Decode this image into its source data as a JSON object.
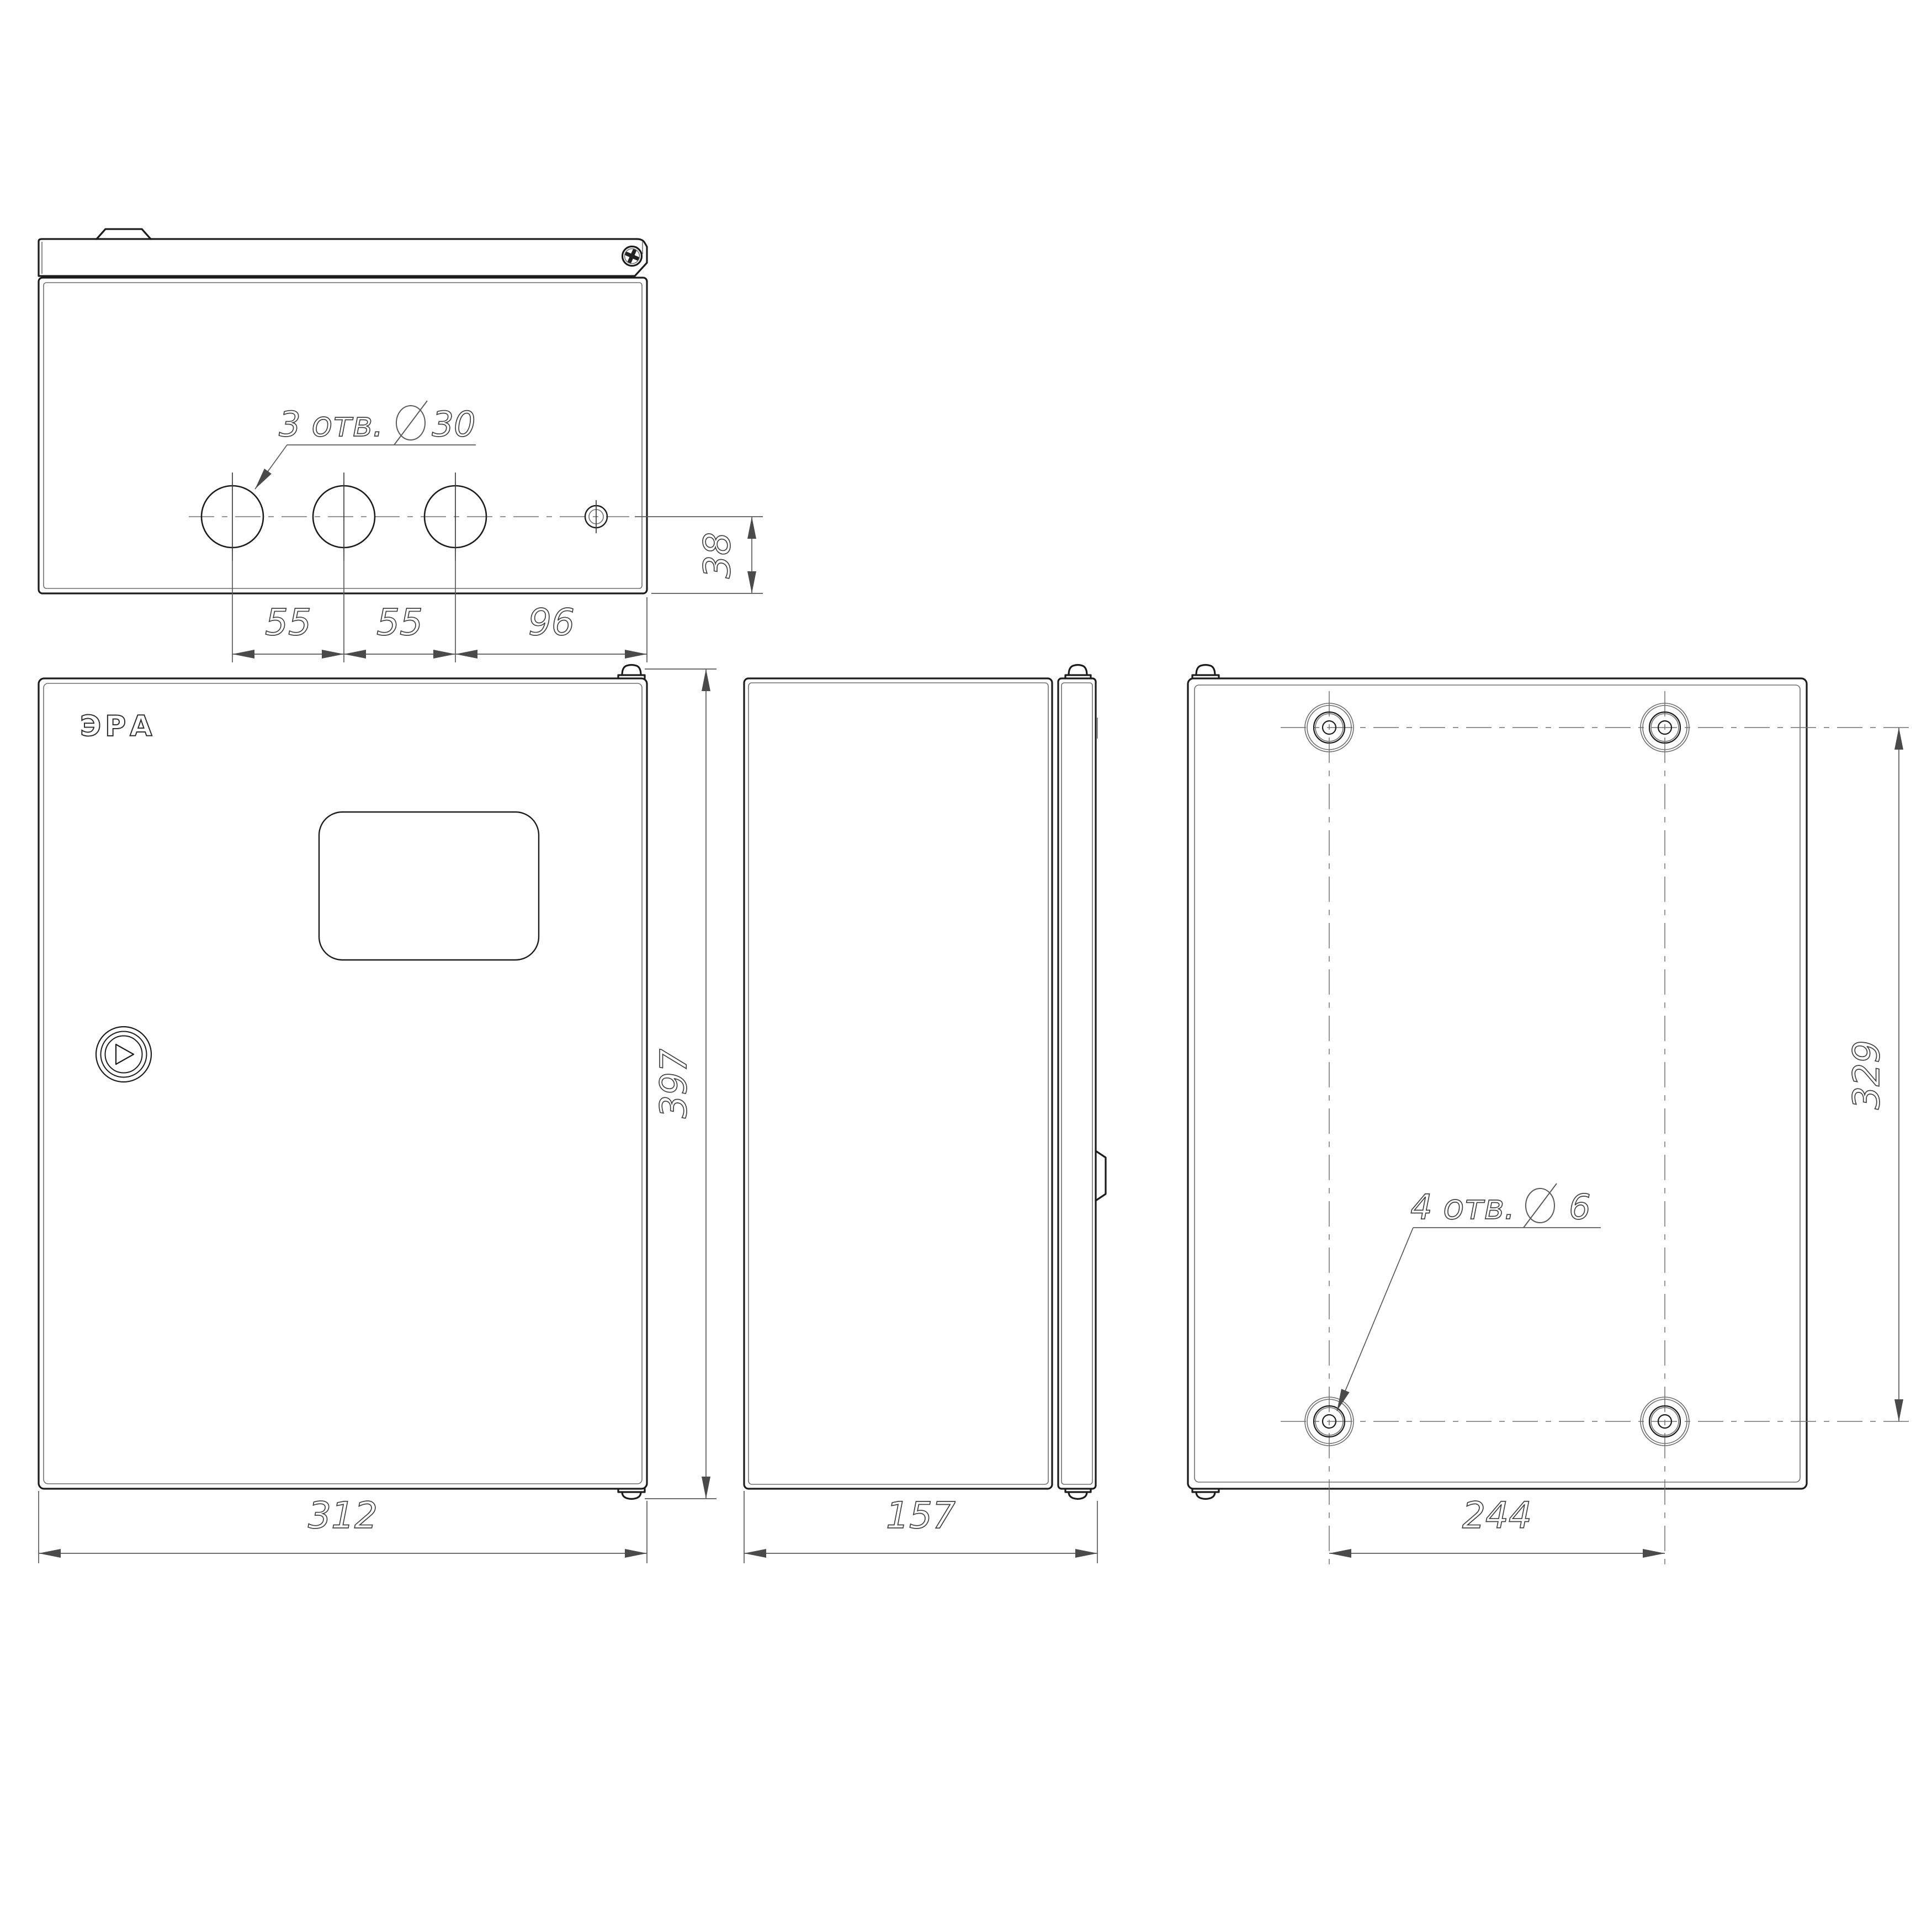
{
  "drawing_title": "Enclosure dimensional drawing",
  "brand": {
    "label": "ЭРА"
  },
  "views": {
    "top": {
      "name": "top-view"
    },
    "front": {
      "name": "front-view"
    },
    "side": {
      "name": "side-view"
    },
    "back": {
      "name": "back-view"
    }
  },
  "annotations": {
    "top_holes_note": {
      "count": "3 отв.",
      "diameter_symbol": "Ø",
      "diameter": "30"
    },
    "back_holes_note": {
      "count": "4 отв.",
      "diameter_symbol": "Ø",
      "diameter": "6"
    }
  },
  "dimensions": {
    "top_hole_pitch_a": "55",
    "top_hole_pitch_b": "55",
    "top_hole_to_edge": "96",
    "top_hole_row_offset": "38",
    "front_height": "397",
    "front_width": "312",
    "side_depth": "157",
    "back_hole_pitch_horizontal": "244",
    "back_hole_pitch_vertical": "329"
  },
  "icons": {
    "diameter_symbol": "slashed-circle Ø",
    "screw_head": "phillips-cross screw",
    "button_glyph": "play-triangle in concentric rings"
  },
  "colors": {
    "background": "#ffffff",
    "object_line": "#1c1c1c",
    "secondary_line": "#6e6e6e",
    "dimension_line": "#5a5a5a",
    "centerline": "#707070",
    "text": "#3f3f3f"
  }
}
